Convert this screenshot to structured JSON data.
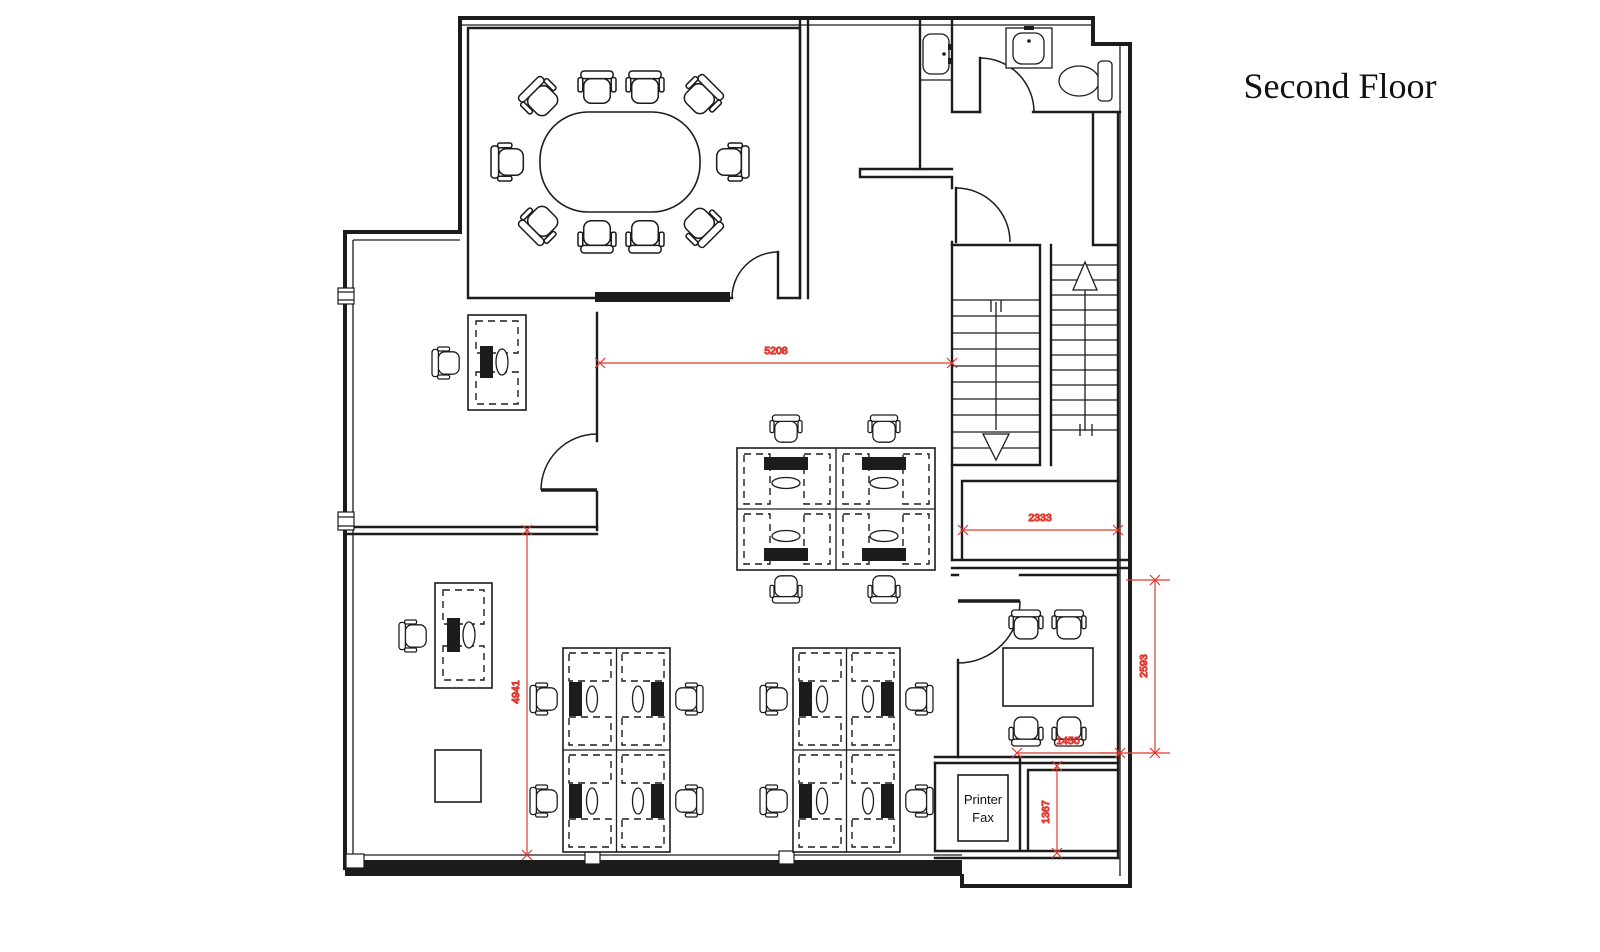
{
  "title": "Second Floor",
  "labels": {
    "printer_line1": "Printer",
    "printer_line2": "Fax"
  },
  "dimensions": {
    "open_office_width": "5208",
    "open_office_height": "4941",
    "upper_right_room_width": "2333",
    "meeting_room_height": "2593",
    "meeting_room_width": "1450",
    "storage_room_height": "1367"
  },
  "colors": {
    "walls": "#1c1c1c",
    "dimensions": "#e03a31",
    "background": "#ffffff"
  }
}
